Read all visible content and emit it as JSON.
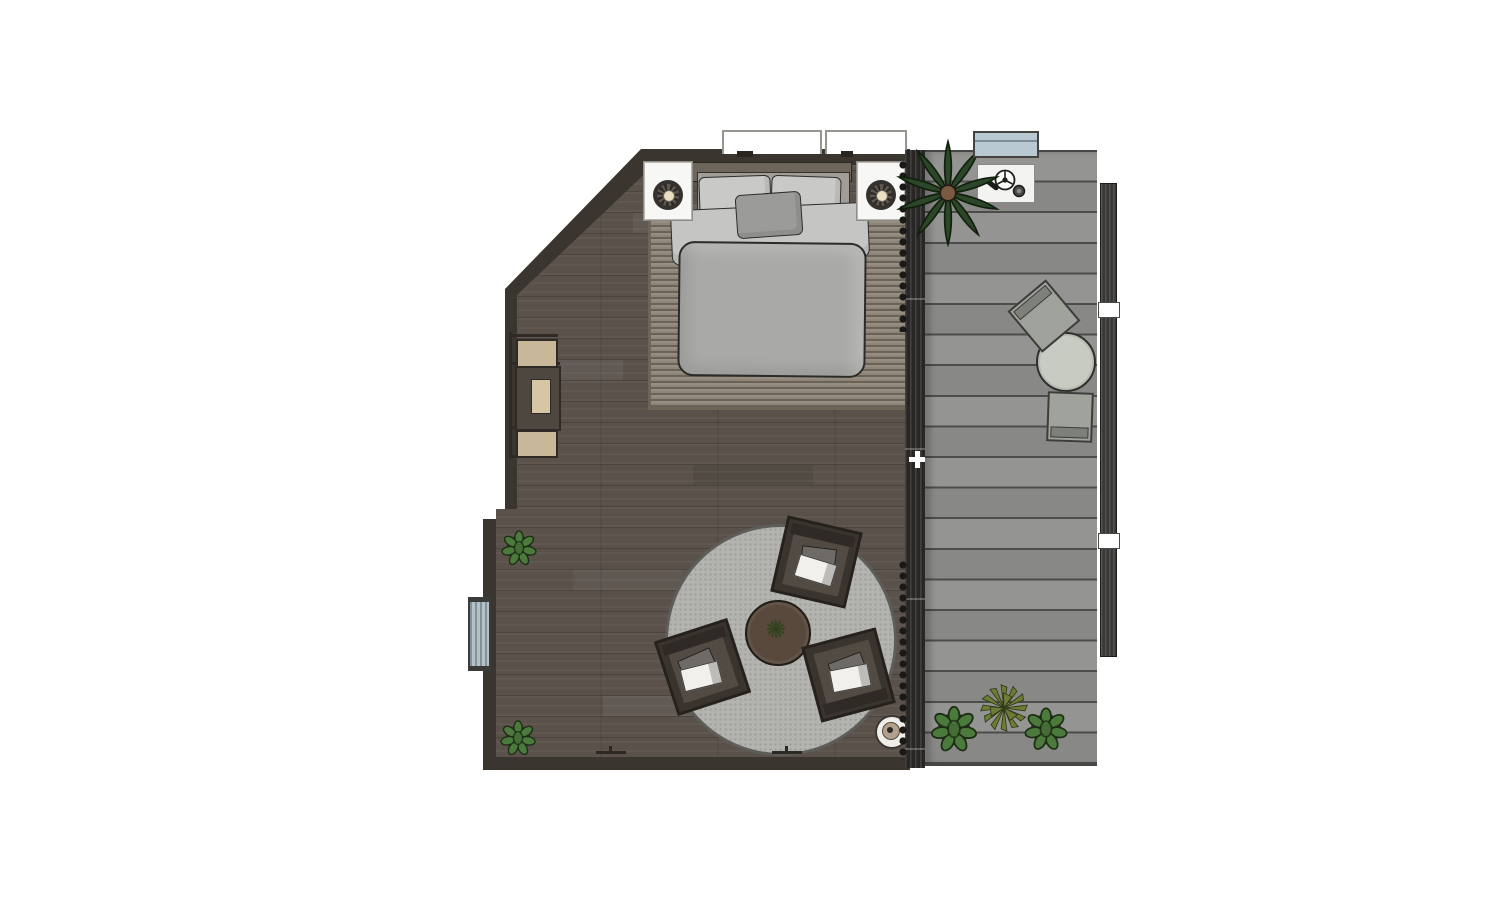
{
  "app": {
    "name": "2D floor plan render",
    "view": "top-down"
  },
  "colors": {
    "wall": "#3b352f",
    "floor_wood": "#59514a",
    "bed_rug": "#8e8578",
    "headboard": "#6e655b",
    "bed_top": "#a19d97",
    "pillow": "#c9c9c7",
    "lumbar": "#9b9b99",
    "sheet": "#c5c5c3",
    "duvet": "#a9a9a7",
    "nightstand": "#f7f7f5",
    "round_rug": "#b3b3af",
    "coffee_table": "#58493c",
    "armchair_seat": "#514b44",
    "desk_wood": "#c8b798",
    "desk_dark": "#4e473f",
    "desk_inner": "#d6c6a6",
    "radiator": "#b4c1c9",
    "divider": "#292725",
    "deck_plank": "#8e8e8c",
    "deck_table": "#c8cbc1",
    "deck_chair": "#a0a39b",
    "railing": "#383735",
    "ac_unit": "#b8c9d2",
    "mat_white": "#f3f3f1",
    "bush_green": "#4c7a3c",
    "palm_green": "#2c4629",
    "agave_green": "#6d7c35",
    "table_plant_green": "#2f4a24",
    "window_fill": "#ffffff"
  },
  "bedroom": {
    "furniture": [
      "double-bed-with-duvet-and-pillows",
      "nightstand-left-with-lamp",
      "nightstand-right-with-lamp",
      "rectangular-area-rug",
      "round-area-rug",
      "round-coffee-table-with-plant",
      "armchair-top",
      "armchair-left",
      "armchair-right",
      "floor-lamp",
      "wall-desk-unit",
      "wall-radiator",
      "potted-plant-upper",
      "potted-plant-lower",
      "window-left",
      "window-right",
      "glass-wall-with-curtains"
    ]
  },
  "deck": {
    "furniture": [
      "palm-plant",
      "doormat-with-grill-tools",
      "bistro-table",
      "deck-chair-upper",
      "deck-chair-lower",
      "planter-bush-left",
      "agave-plant",
      "planter-bush-right",
      "side-railing",
      "ac-unit"
    ]
  }
}
